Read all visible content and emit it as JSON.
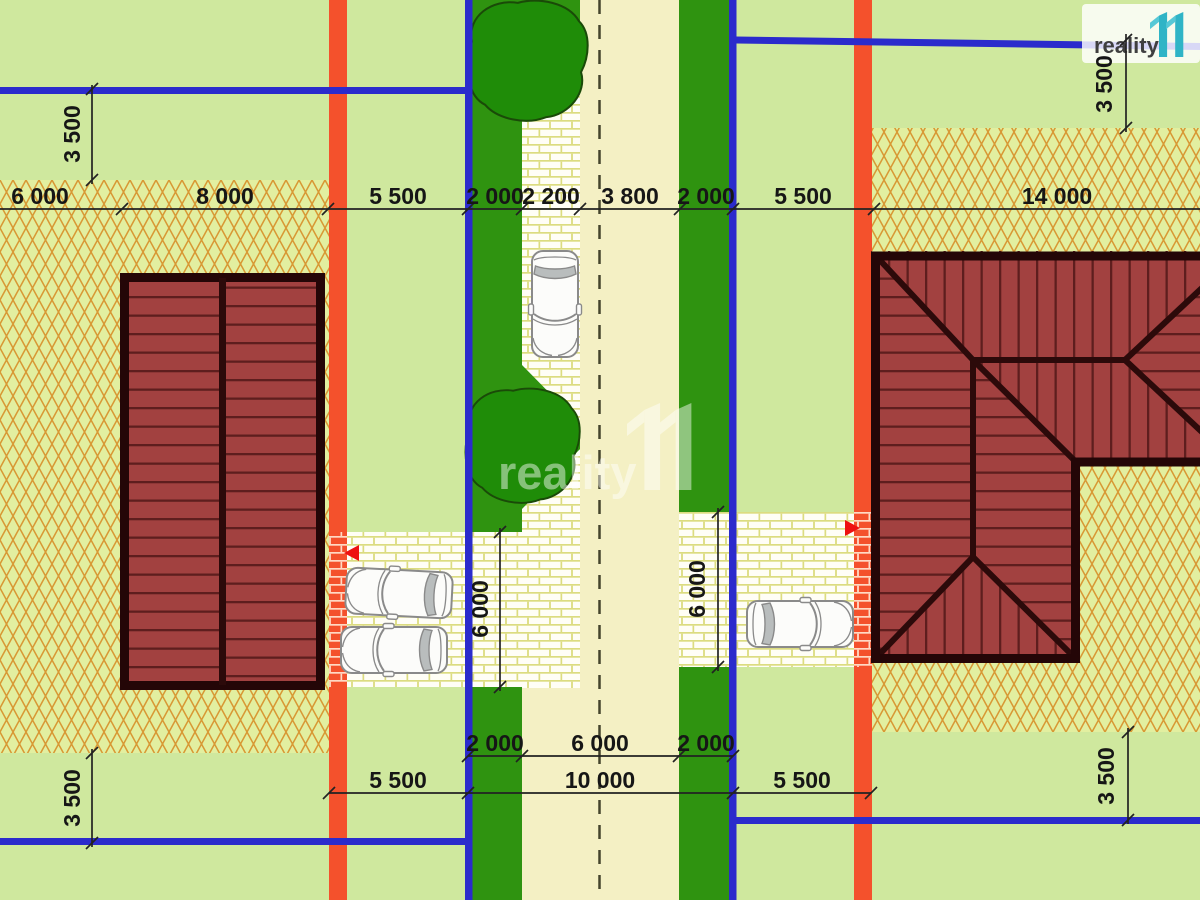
{
  "branding": {
    "logo_text": "reality",
    "logo_mark": "11",
    "watermark_text": "reality",
    "watermark_mark": "11"
  },
  "dims": {
    "top": [
      "6 000",
      "8 000",
      "5 500",
      "2 000",
      "2 200",
      "3 800",
      "2 000",
      "5 500",
      "14 000"
    ],
    "bottom_road": [
      "2 000",
      "6 000",
      "2 000"
    ],
    "bottom_plot": [
      "5 500",
      "10 000",
      "5 500"
    ],
    "vertical": {
      "top_left": "3 500",
      "top_right": "3 500",
      "bottom_left": "3 500",
      "bottom_right": "3 500"
    },
    "driveways": {
      "left": "6 000",
      "right": "6 000"
    }
  },
  "colors": {
    "grass": "#cfe89e",
    "road": "#f4f0c4",
    "hatch_background": "#e2efa0",
    "hatch_line": "#d89834",
    "boundary_orange": "#f4512c",
    "utility_blue": "#2b2bcc",
    "verge_green": "#2f9310",
    "tree_green": "#1f8c08",
    "roof_red": "#a24140",
    "roof_outline": "#240607",
    "brick_joint": "#dcdc80",
    "marker_red": "#ee1111",
    "logo_teal": "#2fb4c6",
    "dimension_text": "#161616"
  }
}
